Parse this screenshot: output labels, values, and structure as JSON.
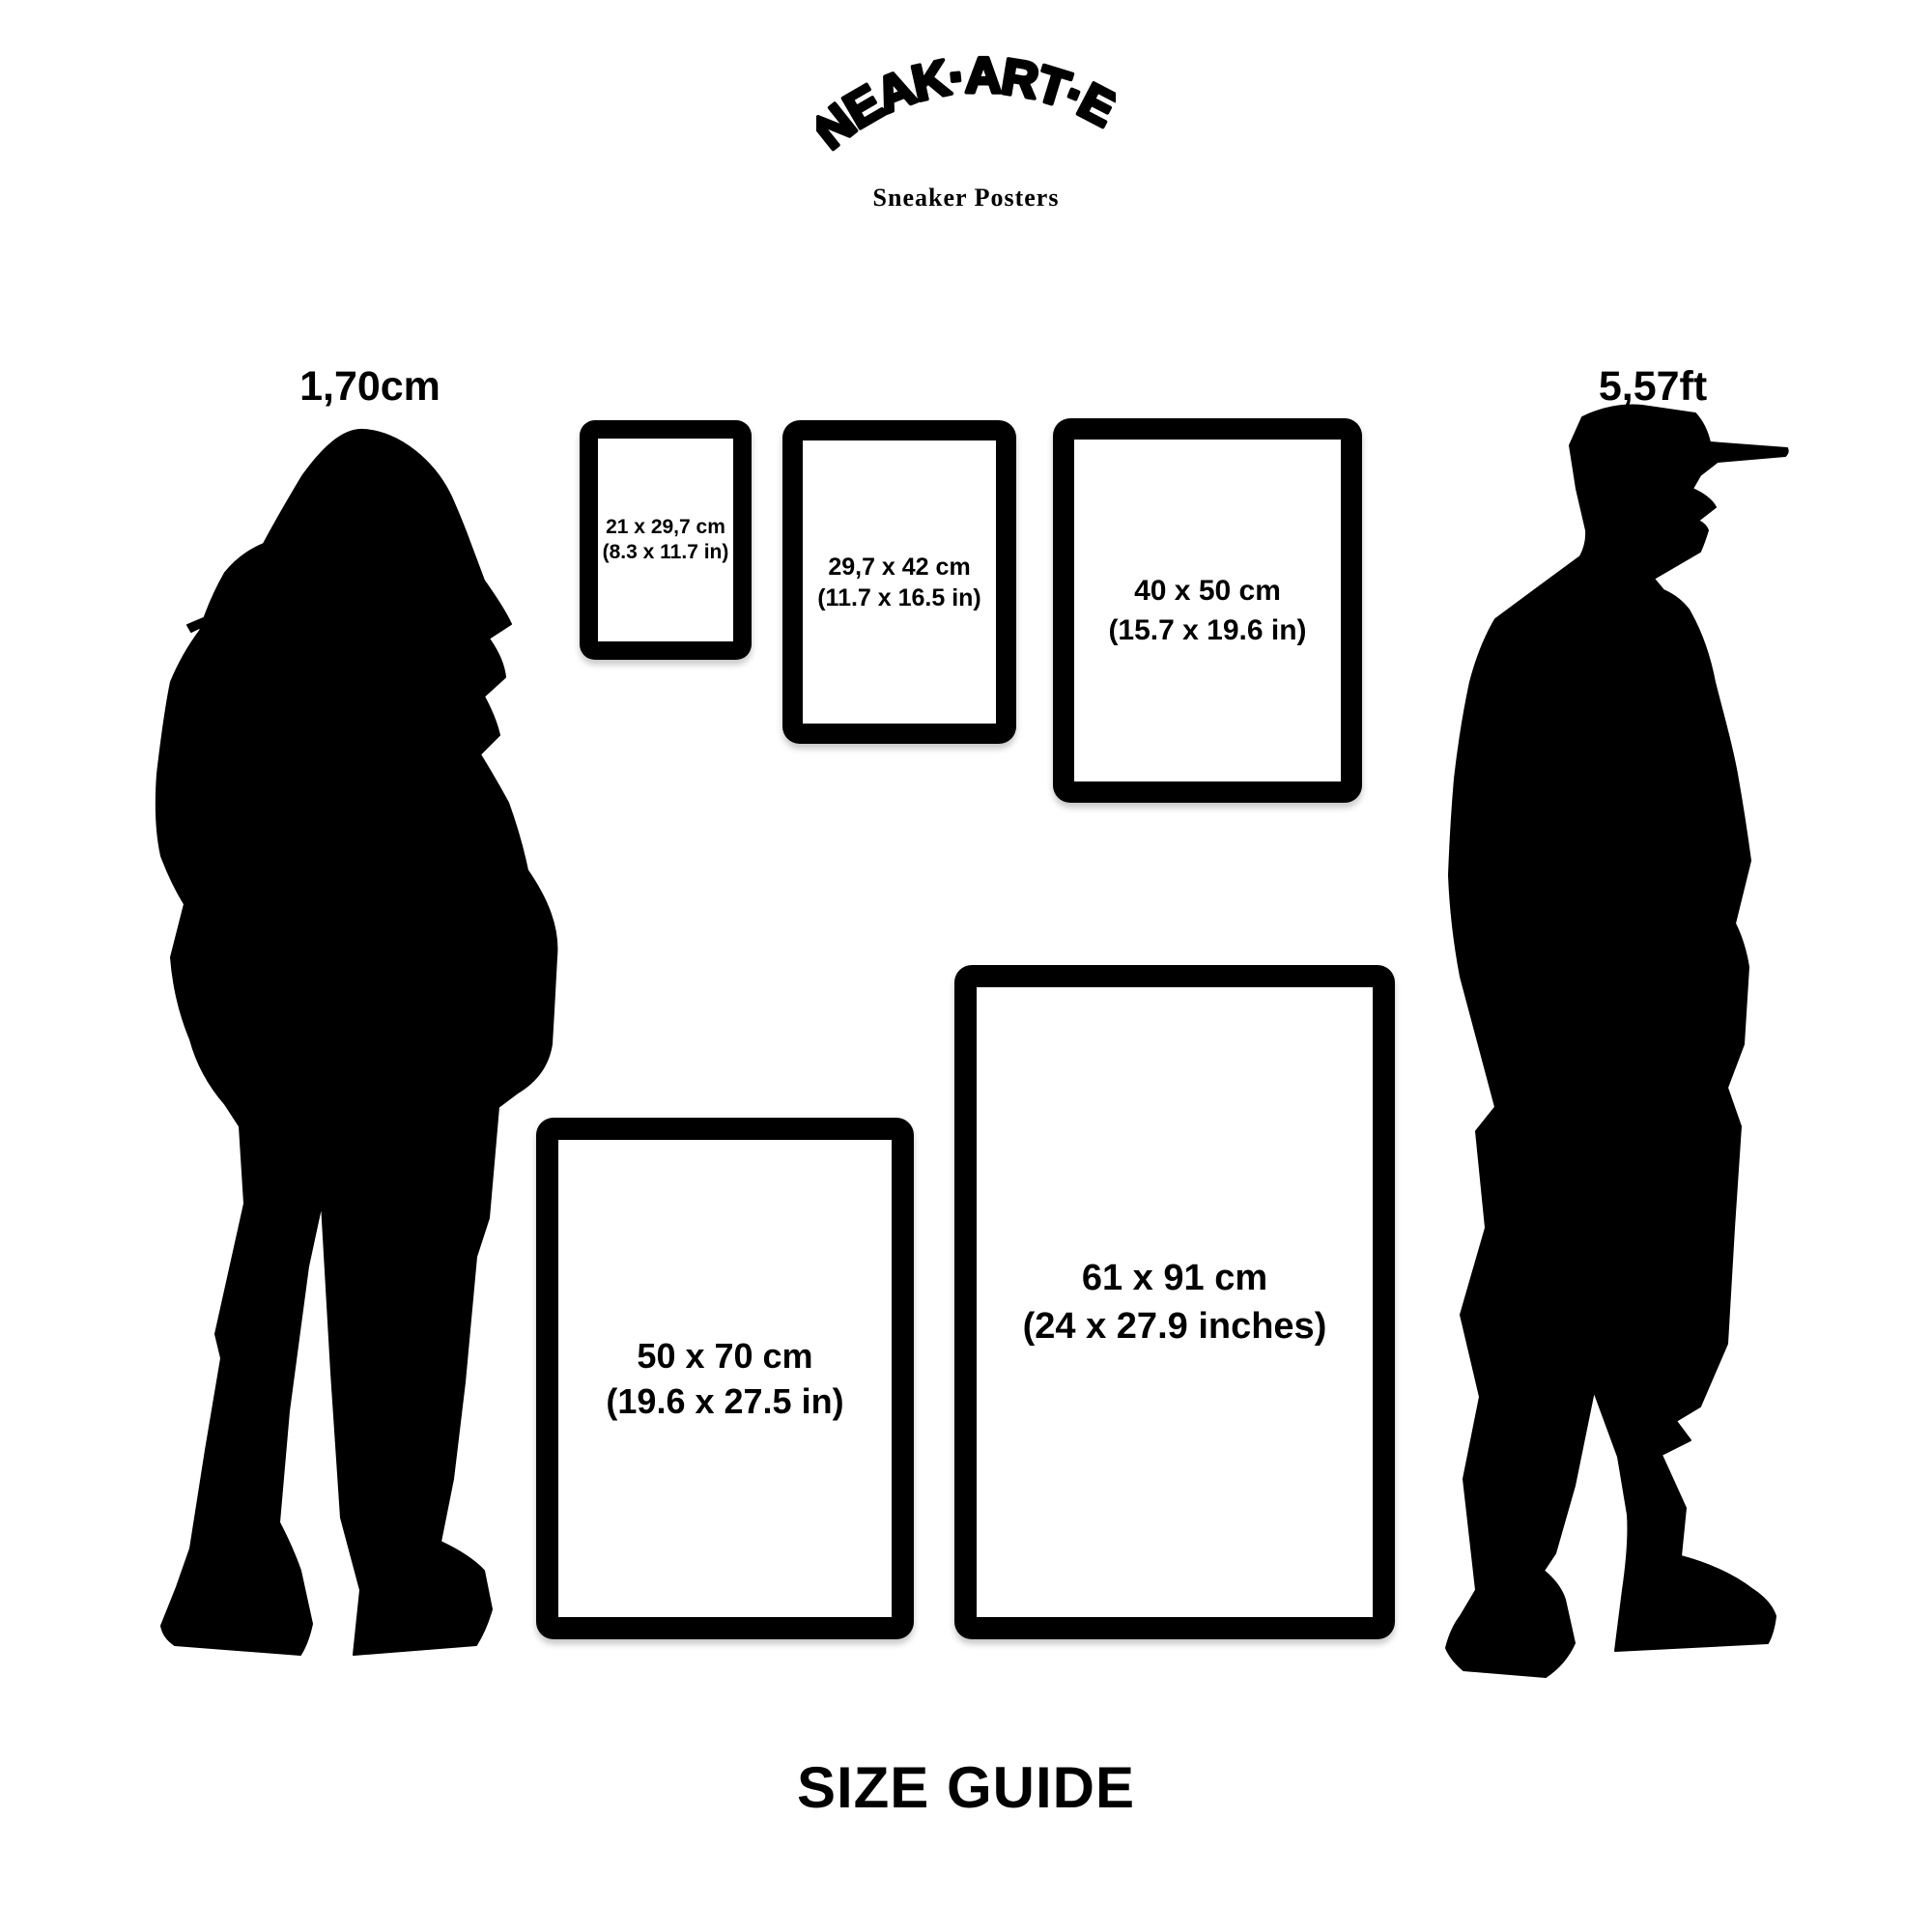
{
  "brand": {
    "logo": "SNEAK·ART·EL",
    "tagline": "Sneaker Posters"
  },
  "page_title": "SIZE GUIDE",
  "reference_figures": {
    "woman": {
      "height_label": "1,70cm"
    },
    "man": {
      "height_label": "5,57ft"
    }
  },
  "frames": [
    {
      "size_cm": "21 x 29,7 cm",
      "size_in": "(8.3 x 11.7 in)"
    },
    {
      "size_cm": "29,7 x 42 cm",
      "size_in": "(11.7 x 16.5 in)"
    },
    {
      "size_cm": "40 x 50 cm",
      "size_in": "(15.7 x 19.6 in)"
    },
    {
      "size_cm": "50 x 70 cm",
      "size_in": "(19.6 x 27.5 in)"
    },
    {
      "size_cm": "61 x 91 cm",
      "size_in": "(24 x 27.9 inches)"
    }
  ],
  "colors": {
    "ink": "#000000",
    "background": "#ffffff"
  }
}
